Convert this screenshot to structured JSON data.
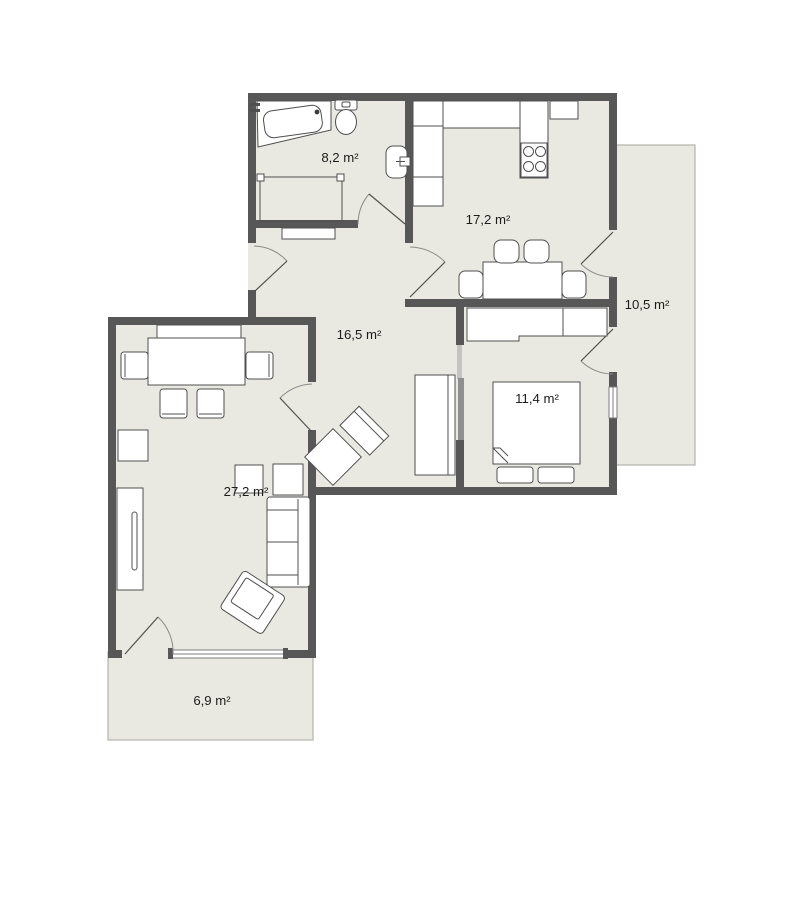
{
  "rooms": [
    {
      "id": "bathroom",
      "label": "8,2 m²"
    },
    {
      "id": "kitchen",
      "label": "17,2 m²"
    },
    {
      "id": "hallway",
      "label": "16,5 m²"
    },
    {
      "id": "bedroom",
      "label": "11,4 m²"
    },
    {
      "id": "living-room",
      "label": "27,2 m²"
    },
    {
      "id": "balcony-right",
      "label": "10,5 m²"
    },
    {
      "id": "balcony-bottom",
      "label": "6,9 m²"
    }
  ],
  "colors": {
    "wall": "#575757",
    "room_fill": "#e9e9e2",
    "furniture_stroke": "#4f4f4f",
    "door_arc": "#8a8a8a",
    "window_frame": "#7d7d7d",
    "balcony_border": "#b3b3ab",
    "label": "#1c1c1c"
  }
}
